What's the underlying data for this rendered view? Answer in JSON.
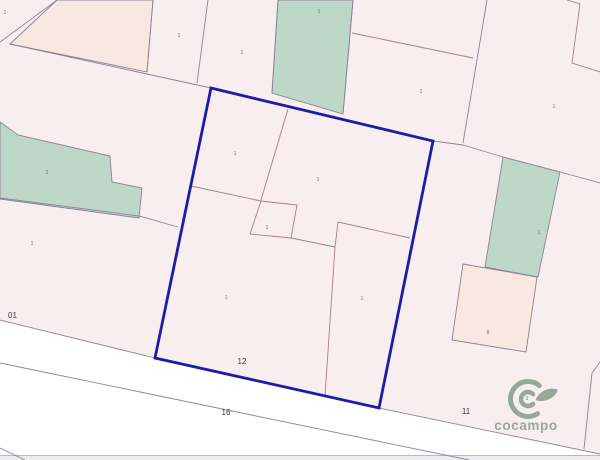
{
  "canvas": {
    "width": 600,
    "height": 460
  },
  "colors": {
    "parcel": "#f8eef0",
    "peach": "#f9e8e2",
    "green": "#bdd8c9",
    "road": "#ffffff",
    "boundary": "#8e8295",
    "inner": "#a8807c",
    "selected": "#1b1ca8",
    "label_dark": "#3a3a42",
    "label_gray": "#6f6f78",
    "label_red": "#9a564e",
    "logo": "#8aa08a",
    "strip_line": "#bababe",
    "strip_fill": "#ededef"
  },
  "map": {
    "base_region": {
      "id": "map-base-land",
      "points": "0,0 600,0 600,454 379,408 155,358 0,320"
    },
    "bottom_strip": {
      "line_y": 455,
      "fill_y": 456.2,
      "fill_height": 3.8
    },
    "parcels": [
      {
        "id": "parcel-peach-top",
        "fill": "peach",
        "points": "57,0 153,0 147,72 10,44"
      },
      {
        "id": "parcel-green-top",
        "fill": "green",
        "points": "278,0 353,0 343,114 272,93"
      },
      {
        "id": "parcel-green-left",
        "fill": "green",
        "points": "0,122 18,135 110,156 112,182 142,188 139,218 0,199"
      },
      {
        "id": "parcel-green-right",
        "fill": "green",
        "points": "503,157 560,172 538,277 485,267"
      },
      {
        "id": "parcel-peach-right",
        "fill": "peach",
        "points": "463,264 537,277 526,352 452,340"
      }
    ],
    "inner_parcel": {
      "id": "parcel-inner-square",
      "points": "261,201 297,205 291,238 250,234"
    },
    "boundaries": [
      "0,42 57,0",
      "10,44 211,88",
      "153,0 147,72",
      "208,0 197,83",
      "278,0 272,93",
      "353,0 343,114",
      "487,0 463,143",
      "433,141 463,145",
      "463,145 503,157 560,172 600,183",
      "0,198 139,216 178,227",
      "0,320 155,358",
      "379,408 600,454",
      "0,363 469,460",
      "0,448 25,460",
      "600,362 592,373 584,449"
    ],
    "inner_lines": [
      "567,0 580,4 572,63 600,72",
      "352,33 473,58",
      "288,109 261,200",
      "191,186 261,201",
      "291,238 335,247",
      "335,247 338,222",
      "338,222 410,238",
      "335,247 325,396"
    ],
    "selected_parcel": {
      "id": "selected-parcel",
      "points": "211,88 433,141 379,408 155,358",
      "stroke_width": 2.8
    },
    "labels": [
      {
        "text": "01",
        "x": 8,
        "y": 318,
        "size": 8,
        "color": "label_dark",
        "anchor": "start",
        "name": "parcel-number-01"
      },
      {
        "text": "12",
        "x": 242,
        "y": 364,
        "size": 8,
        "color": "label_dark",
        "name": "parcel-number-12"
      },
      {
        "text": "16",
        "x": 226,
        "y": 415,
        "size": 8,
        "color": "label_dark",
        "name": "road-number-16"
      },
      {
        "text": "11",
        "x": 466,
        "y": 414,
        "size": 8,
        "color": "label_dark",
        "name": "parcel-number-11"
      },
      {
        "text": "1",
        "x": 5,
        "y": 14,
        "size": 5,
        "color": "label_gray",
        "name": "subparcel-label"
      },
      {
        "text": "1",
        "x": 179,
        "y": 37,
        "size": 5,
        "color": "label_gray",
        "name": "subparcel-label"
      },
      {
        "text": "1",
        "x": 242,
        "y": 54,
        "size": 5,
        "color": "label_red",
        "name": "subparcel-label"
      },
      {
        "text": "1",
        "x": 319,
        "y": 13,
        "size": 5,
        "color": "label_red",
        "name": "subparcel-label"
      },
      {
        "text": "1",
        "x": 47,
        "y": 174,
        "size": 5,
        "color": "label_red",
        "name": "subparcel-label"
      },
      {
        "text": "1",
        "x": 421,
        "y": 93,
        "size": 5,
        "color": "label_gray",
        "name": "subparcel-label"
      },
      {
        "text": "1",
        "x": 554,
        "y": 108,
        "size": 5,
        "color": "label_gray",
        "name": "subparcel-label"
      },
      {
        "text": "1",
        "x": 235,
        "y": 155,
        "size": 5,
        "color": "label_gray",
        "name": "subparcel-label"
      },
      {
        "text": "1",
        "x": 318,
        "y": 181,
        "size": 5,
        "color": "label_gray",
        "name": "subparcel-label"
      },
      {
        "text": "1",
        "x": 267,
        "y": 229,
        "size": 5,
        "color": "label_gray",
        "name": "subparcel-label"
      },
      {
        "text": "1",
        "x": 226,
        "y": 299,
        "size": 5,
        "color": "label_gray",
        "name": "subparcel-label"
      },
      {
        "text": "1",
        "x": 362,
        "y": 300,
        "size": 5,
        "color": "label_gray",
        "name": "subparcel-label"
      },
      {
        "text": "1",
        "x": 32,
        "y": 245,
        "size": 5,
        "color": "label_gray",
        "name": "subparcel-label"
      },
      {
        "text": "1",
        "x": 539,
        "y": 234,
        "size": 5,
        "color": "label_red",
        "name": "subparcel-label"
      },
      {
        "text": "8",
        "x": 488,
        "y": 334,
        "size": 5,
        "color": "label_red",
        "name": "subparcel-label"
      },
      {
        "text": "1",
        "x": 527,
        "y": 400,
        "size": 5,
        "color": "label_gray",
        "name": "subparcel-label"
      }
    ]
  },
  "logo": {
    "text": "cocampo"
  }
}
